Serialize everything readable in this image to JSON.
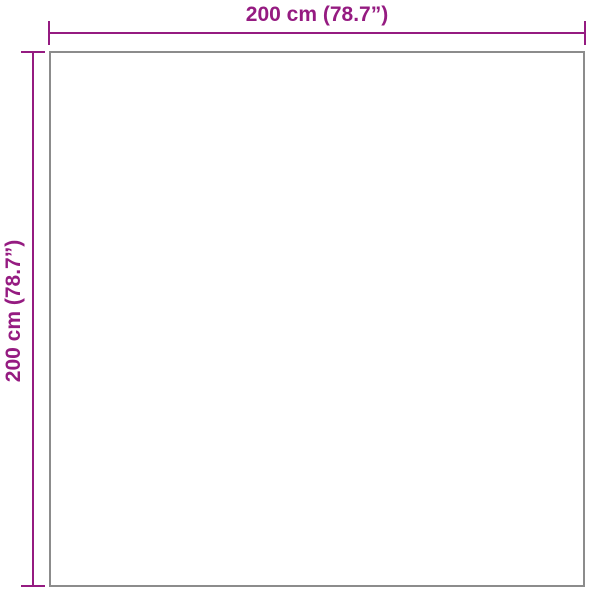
{
  "diagram": {
    "type": "product-dimension-diagram",
    "shape": "square",
    "top_dimension": {
      "label": "200 cm (78.7”)"
    },
    "left_dimension": {
      "label": "200 cm (78.7”)"
    },
    "colors": {
      "dimension_color": "#951B81",
      "outline_color": "#8C8C8C",
      "background": "#FFFFFF"
    }
  }
}
